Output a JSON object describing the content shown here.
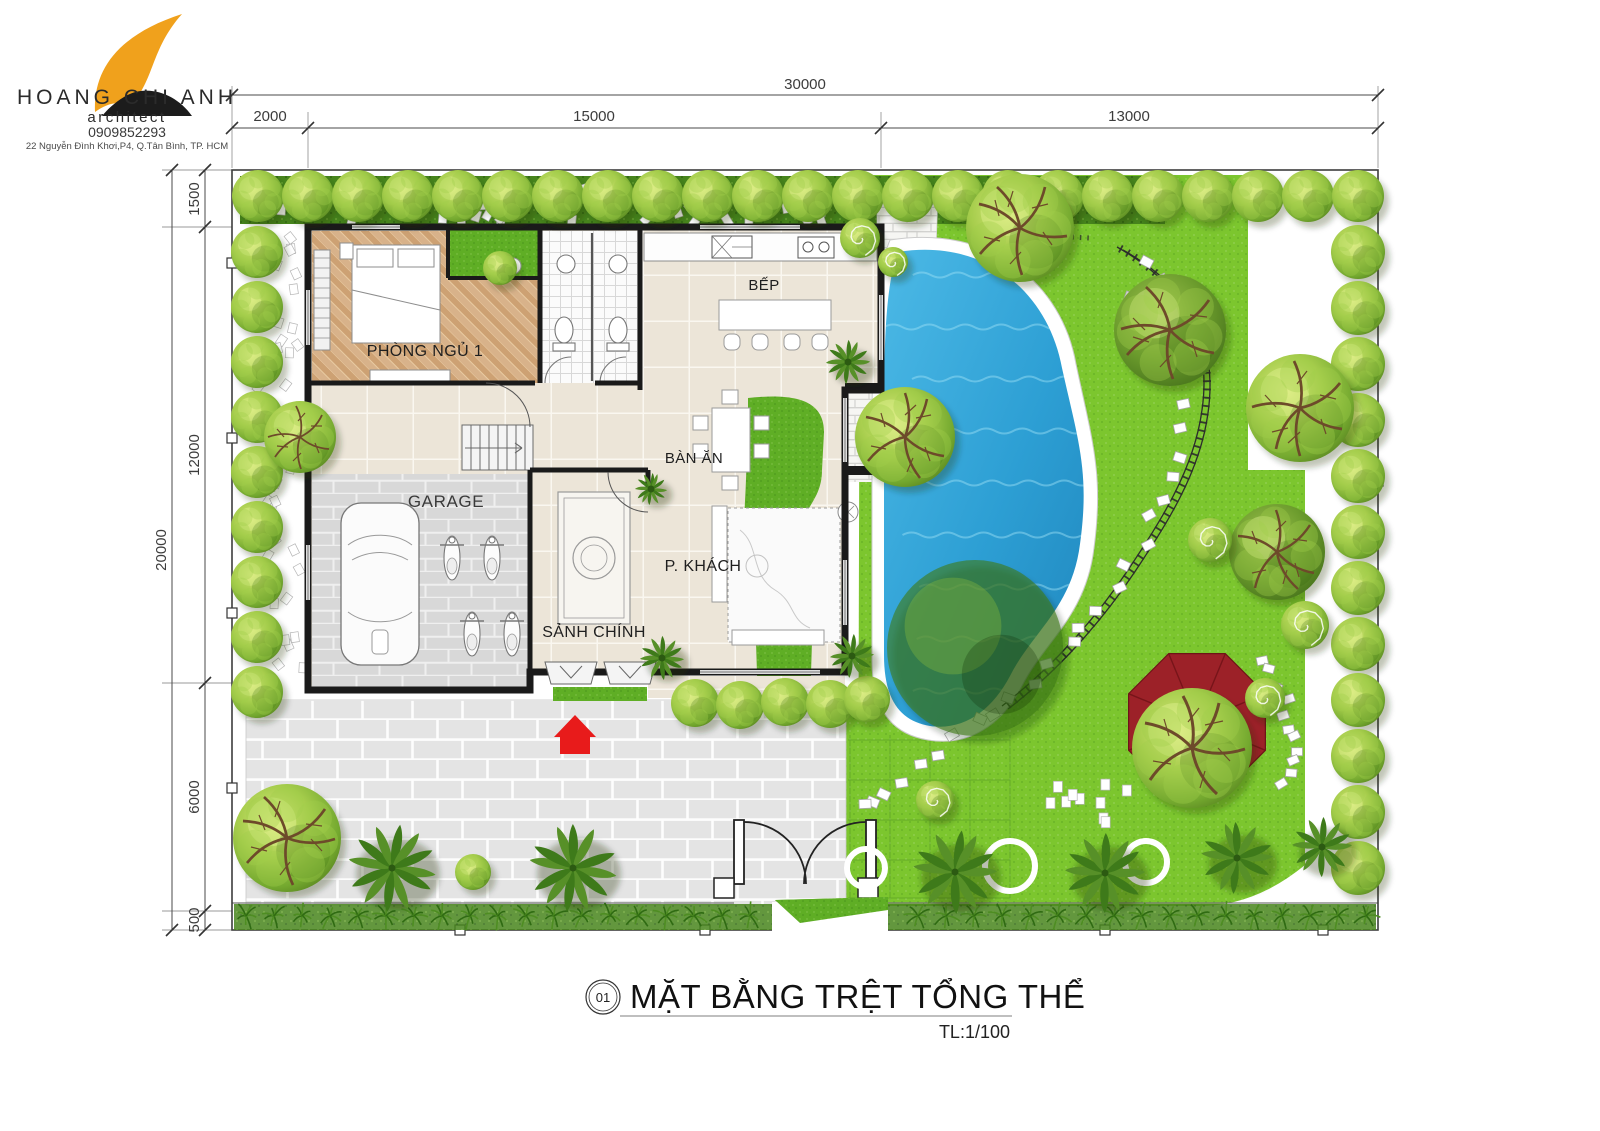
{
  "header": {
    "brand": "HOANG CHI ANH",
    "profession": "architect",
    "phone": "0909852293",
    "address": "22 Nguyễn Đình Khơi,P4, Q.Tân Bình, TP. HCM"
  },
  "dimensions": {
    "top_total": "30000",
    "top_segments": [
      "2000",
      "15000",
      "13000"
    ],
    "left_total": "20000",
    "left_segments": [
      "1500",
      "12000",
      "6000",
      "500"
    ]
  },
  "rooms": {
    "bedroom": "PHÒNG NGỦ 1",
    "kitchen": "BẾP",
    "dining": "BÀN ĂN",
    "garage": "GARAGE",
    "living": "P. KHÁCH",
    "lobby": "SẢNH CHÍNH"
  },
  "title_block": {
    "number": "01",
    "title": "MẶT BẰNG TRỆT TỔNG THỂ",
    "scale": "TL:1/100"
  },
  "colors": {
    "lawn": "#7cc62e",
    "hedge_green": "#47851c",
    "pool_water": "#2d9fd4",
    "wall_black": "#1a1a1a",
    "wood_floor": "#d8b28a",
    "tile_floor": "#ece5d8",
    "garage_floor": "#d8d8d8",
    "courtyard_paver": "#e4e4e4",
    "gazebo_roof": "#9c2128",
    "entry_arrow": "#e81b1b",
    "logo_orange": "#f0a11c",
    "logo_black": "#1c1c1c"
  }
}
